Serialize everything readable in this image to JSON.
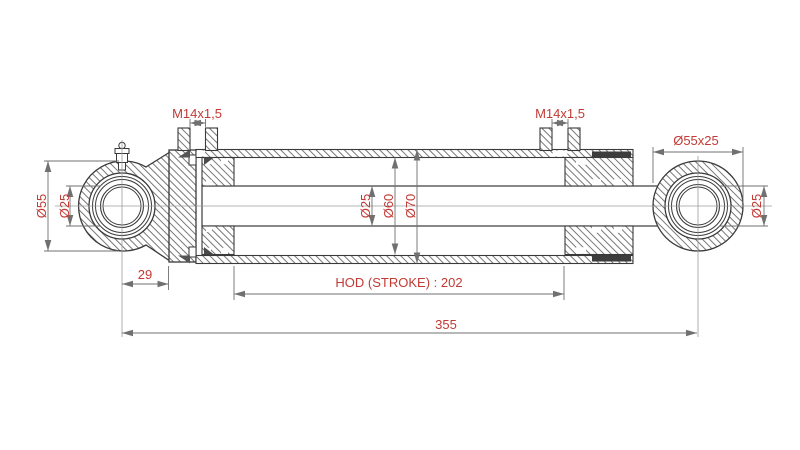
{
  "drawing": {
    "labels": {
      "port_left": "M14x1,5",
      "port_right": "M14x1,5",
      "right_eye_size": "Ø55x25",
      "right_eye_bore": "Ø25",
      "left_eye_outer": "Ø55",
      "left_eye_bore": "Ø25",
      "rod_diameter": "Ø25",
      "bore_diameter": "Ø60",
      "outer_diameter": "Ø70",
      "left_offset": "29",
      "stroke": "HOD (STROKE) : 202",
      "overall_length": "355"
    },
    "colors": {
      "dimension_text": "#c13a34",
      "geometry_line": "#3a3a3a",
      "dimension_line": "#707070",
      "centerline": "#9b9b9b",
      "hatch_line": "#555555",
      "seal_fill": "#3d3d3d",
      "background": "#ffffff"
    }
  }
}
